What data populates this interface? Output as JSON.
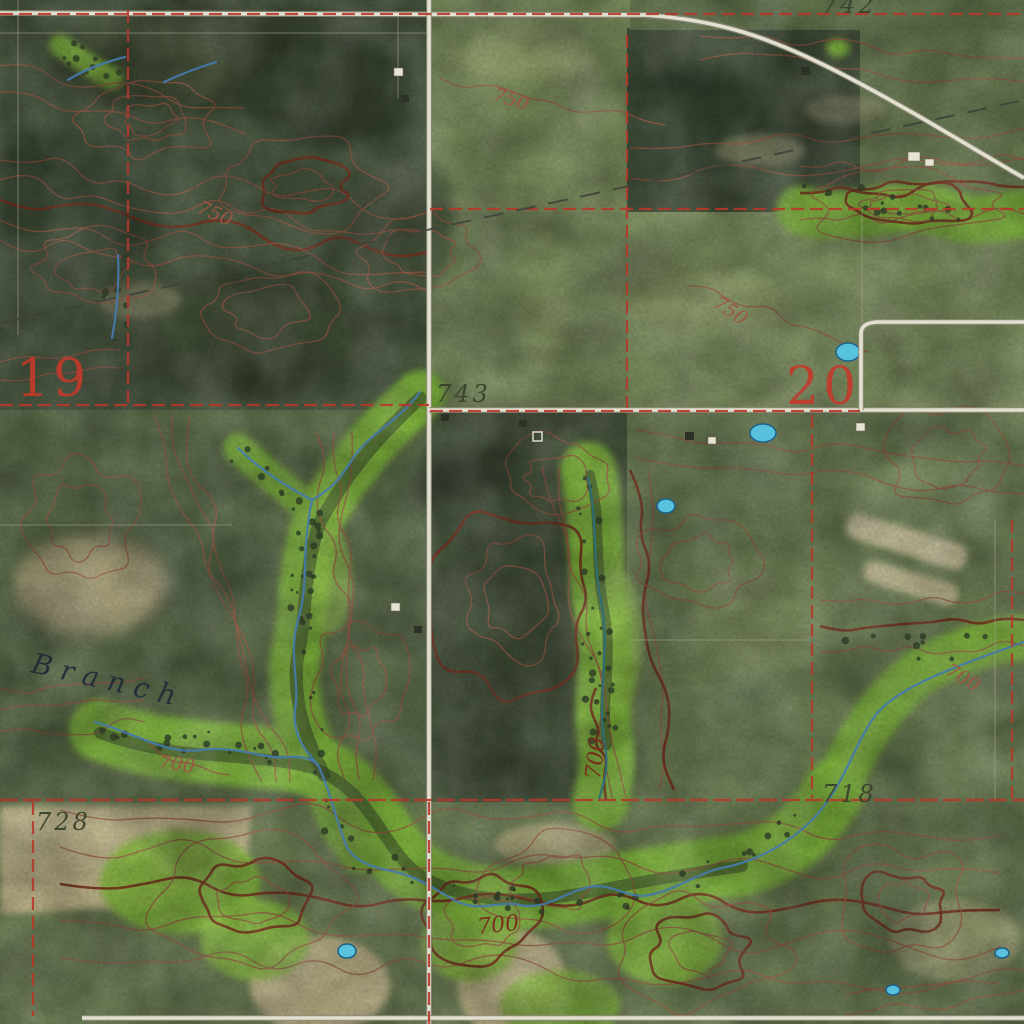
{
  "map": {
    "description": "USGS-style topographic map over aerial imagery, sections 19 and 20",
    "labels": {
      "sections": [
        {
          "text": "19"
        },
        {
          "text": "20"
        }
      ],
      "spot_elevations": [
        {
          "text": "743"
        },
        {
          "text": "742"
        },
        {
          "text": "728"
        },
        {
          "text": "718"
        }
      ],
      "contour_labels": [
        {
          "text": "750"
        },
        {
          "text": "750"
        },
        {
          "text": "750"
        },
        {
          "text": "700"
        },
        {
          "text": "700"
        },
        {
          "text": "700"
        },
        {
          "text": "700"
        }
      ],
      "stream_labels": [
        {
          "text": "Branch"
        }
      ]
    },
    "colors": {
      "field-mid": "#5e6f4c",
      "field-light": "#7d8f5e",
      "field-pale": "#93a069",
      "woods-dark": "#49573e",
      "woods-darker": "#394630",
      "riparian": "#7fb33c",
      "riparian-light": "#97c84e",
      "tan": "#cabc92",
      "tan-light": "#dcd2ab",
      "contour": "#9c5743",
      "contour-index": "#77301c",
      "section-red": "#b5392a",
      "label-red": "#c13b2c",
      "road-fill": "#e3e0d0",
      "road-casing": "#8e8c7a",
      "boundary-gray": "#a9a795",
      "stream-blue": "#4579ab",
      "pond-fill": "#58c2de",
      "pond-edge": "#1f6286",
      "spot-dark": "#39422c",
      "stream-label": "#1d2a38",
      "powerline": "#3c423a"
    }
  }
}
